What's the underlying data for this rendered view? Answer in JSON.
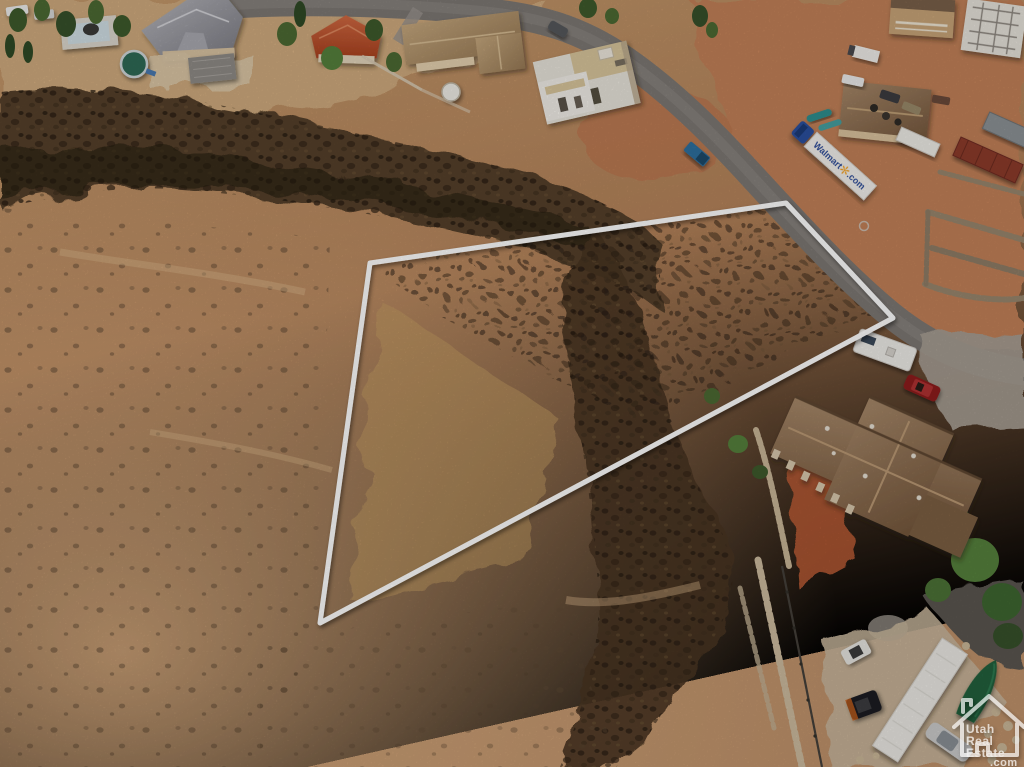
{
  "meta": {
    "title": "Aerial drone photo of desert land parcel with boundary outline",
    "width": 1024,
    "height": 767
  },
  "watermark": {
    "line1": "Utah",
    "line2": "Real",
    "line3": "Estate",
    "line4": ".com"
  },
  "parcel_outline": {
    "points": "370,263 786,203 893,318 320,623",
    "stroke": "#ffffff"
  },
  "vehicles": {
    "truck_brand": "Walmart",
    "truck_suffix": ".com"
  },
  "palette": {
    "desert_light": "#cda378",
    "desert_mid": "#b98a5e",
    "desert_dark": "#a87c54",
    "basalt_rock": "#38291b",
    "road_gray": "#7e7975",
    "red_dirt": "#c07e55",
    "roof_brown": "#8a6a4c",
    "roof_terracotta": "#c25432",
    "pool_green": "#2f6b57",
    "truck_blue": "#2b4f9e",
    "walmart_spark": "#f5a623",
    "tree_green": "#4c6a33",
    "outline_white": "#ffffff"
  }
}
